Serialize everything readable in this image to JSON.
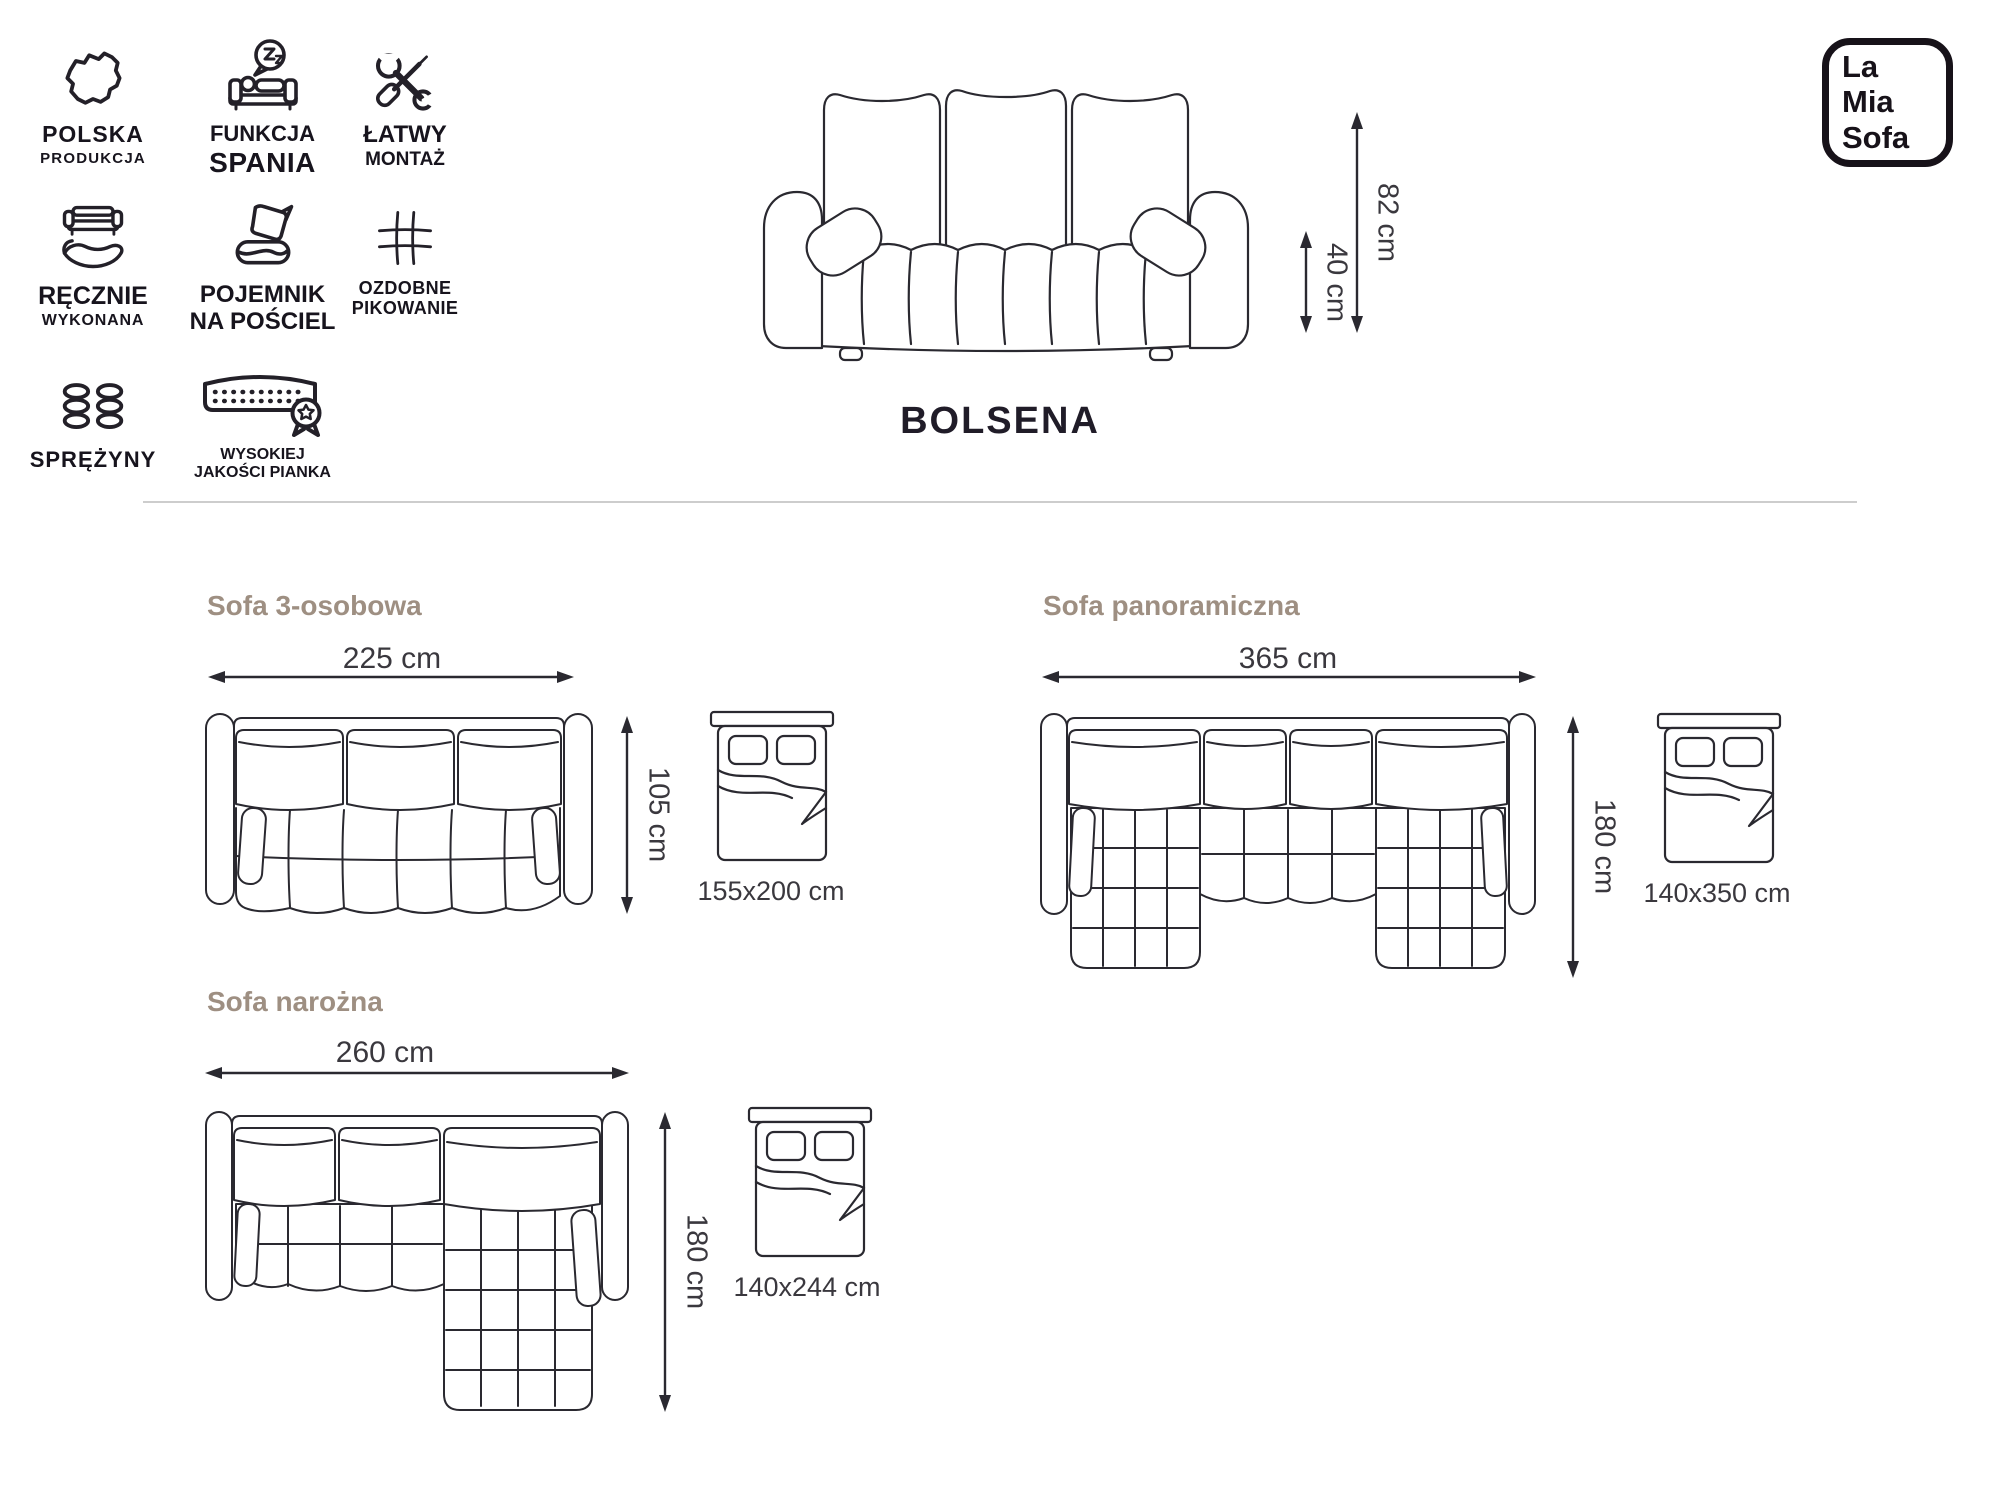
{
  "colors": {
    "ink": "#2a2930",
    "heading": "#9e8f82",
    "divider": "#cdcdcd",
    "label_text": "#3a383e",
    "logo_ink": "#171219"
  },
  "features": [
    {
      "icon": "poland-map",
      "line1": "POLSKA",
      "line2": "PRODUKCJA"
    },
    {
      "icon": "sleep-function",
      "line1": "FUNKCJA",
      "line2": "SPANIA"
    },
    {
      "icon": "easy-assembly-tools",
      "line1": "ŁATWY",
      "line2": "MONTAŻ"
    },
    {
      "icon": "handmade-sofa-hand",
      "line1": "RĘCZNIE",
      "line2": "WYKONANA"
    },
    {
      "icon": "bedding-storage",
      "line1": "POJEMNIK",
      "line2": "NA POŚCIEL"
    },
    {
      "icon": "decorative-quilting",
      "line1": "OZDOBNE",
      "line2": "PIKOWANIE"
    },
    {
      "icon": "springs",
      "line1": "SPRĘŻYNY",
      "line2": ""
    },
    {
      "icon": "high-quality-foam",
      "line1": "WYSOKIEJ",
      "line2": "JAKOŚCI PIANKA"
    }
  ],
  "product": {
    "name": "BOLSENA",
    "overall_height": "82 cm",
    "seat_height": "40 cm"
  },
  "logo": {
    "line1": "La",
    "line2": "Mia",
    "line3": "Sofa"
  },
  "variants": [
    {
      "title": "Sofa 3-osobowa",
      "width": "225 cm",
      "depth": "105 cm",
      "bed_size": "155x200 cm"
    },
    {
      "title": "Sofa panoramiczna",
      "width": "365 cm",
      "depth": "180 cm",
      "bed_size": "140x350 cm"
    },
    {
      "title": "Sofa narożna",
      "width": "260 cm",
      "depth": "180 cm",
      "bed_size": "140x244 cm"
    }
  ]
}
